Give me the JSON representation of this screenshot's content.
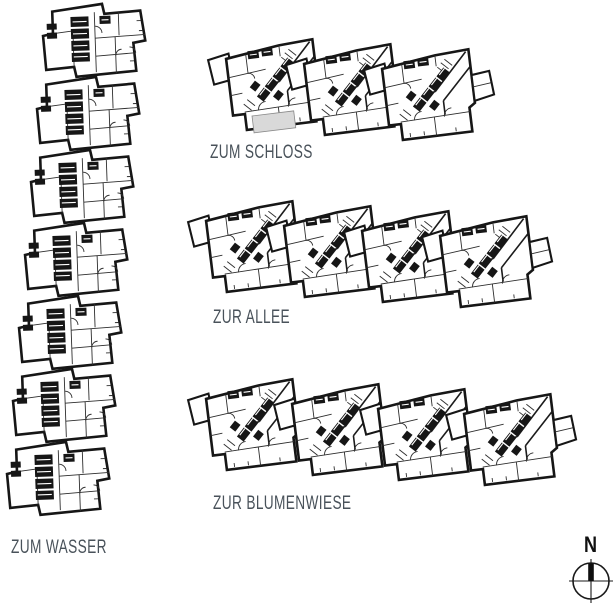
{
  "colors": {
    "ink": "#161616",
    "label_text": "#49525a",
    "highlight_fill": "#d9d9d9",
    "background": "#ffffff"
  },
  "site": {
    "rows": [
      {
        "id": "schloss",
        "label": "ZUM SCHLOSS",
        "units": 3
      },
      {
        "id": "allee",
        "label": "ZUR ALLEE",
        "units": 4
      },
      {
        "id": "blumenwiese",
        "label": "ZUR BLUMENWIESE",
        "units": 4
      }
    ],
    "column": {
      "id": "wasser",
      "label": "ZUM WASSER",
      "units": 7
    },
    "compass": {
      "label": "N"
    }
  }
}
